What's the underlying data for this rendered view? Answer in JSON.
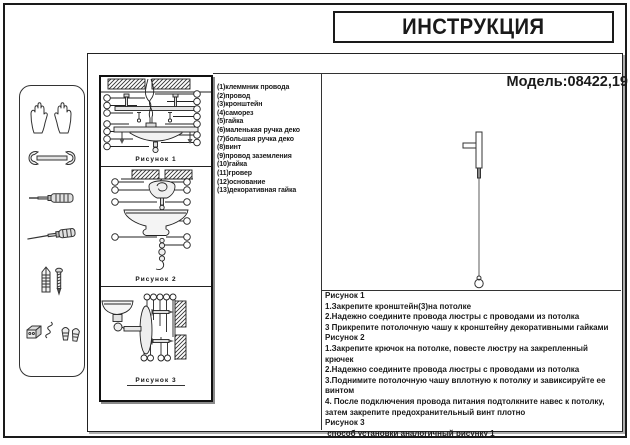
{
  "header": {
    "title": "ИНСТРУКЦИЯ",
    "model": "Модель:08422,19"
  },
  "parts_list": {
    "items": [
      "(1)клеммник провода",
      "(2)провод",
      "(3)кронштейн",
      "(4)саморез",
      "(5)гайка",
      "(6)маленькая ручка деко",
      "(7)большая ручка деко",
      "(8)винт",
      "(9)провод заземления",
      "(10)гайка",
      "(11)гровер",
      "(12)основание",
      "(13)декоративная гайка"
    ]
  },
  "figures": {
    "fig1_label": "Рисунок 1",
    "fig2_label": "Рисунок 2",
    "fig3_label": "Рисунок 3"
  },
  "instructions": {
    "sections": [
      {
        "title": "Рисунок 1",
        "steps": [
          "1.Закрепите кронштейн(3)на потолке",
          "2.Надежно соедините провода люстры с проводами из потолка",
          "3 Прикрепите потолочную чашу к кронштейну декоративными гайками"
        ]
      },
      {
        "title": "Рисунок 2",
        "steps": [
          "1.Закрепите крючок на потолке, повесте люстру на закрепленный крючек",
          "2.Надежно соедините провода люстры с проводами из потолка",
          "3.Поднимите потолочную чашу вплотную к потолку и завиксируйте ее винтом",
          "4. После подключения провода питания подтолкните навес к потолку, затем закрепите предохранительный винт плотно"
        ]
      },
      {
        "title": "Рисунок 3",
        "steps": [
          " способ установки аналогичный рисунку 1"
        ]
      }
    ]
  },
  "sidebar": {
    "tools": [
      "gloves",
      "wrench",
      "screwdriver",
      "awl-screwdriver",
      "anchor-and-screw",
      "fasteners"
    ]
  },
  "colors": {
    "ink": "#1a1a1a",
    "paper": "#ffffff"
  }
}
